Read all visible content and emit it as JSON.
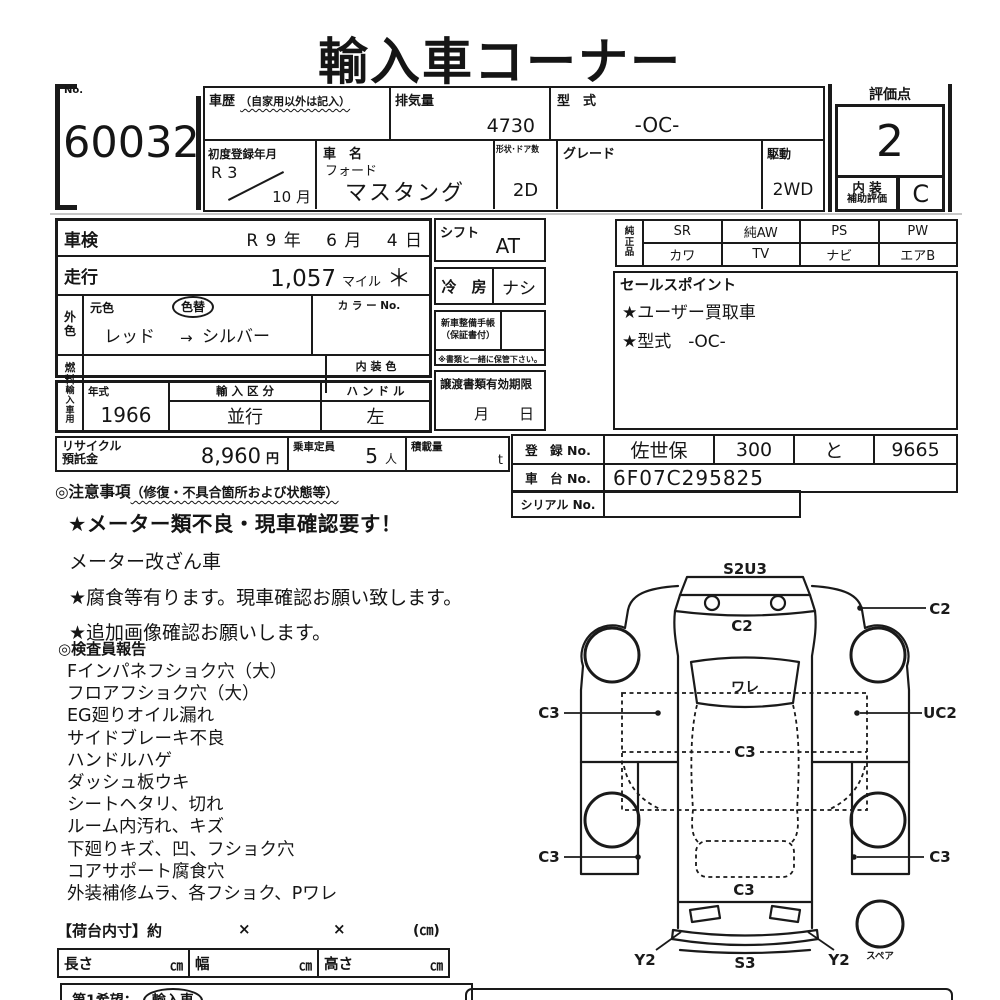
{
  "title": "輸入車コーナー",
  "lot": {
    "no_label": "No.",
    "number": "60032"
  },
  "header": {
    "history_label": "車歴",
    "history_note": "（自家用以外は記入）",
    "displacement_label": "排気量",
    "displacement": "4730",
    "model_code_label": "型　式",
    "model_code": "-OC-",
    "first_reg_label": "初度登録年月",
    "first_reg_year": "R 3",
    "first_reg_month": "10 月",
    "name_label": "車　名",
    "maker": "フォード",
    "car_name": "マスタング",
    "doors_label": "形状･ドア数",
    "doors": "2D",
    "grade_label": "グレード",
    "grade": "",
    "drive_label": "駆動",
    "drive": "2WD"
  },
  "rating": {
    "label": "評価点",
    "score": "2",
    "interior_label1": "内 装",
    "interior_label2": "補助評価",
    "interior_grade": "C"
  },
  "info": {
    "shaken_label": "車検",
    "shaken_value": "R 9 年　 6 月　 4 日",
    "mileage_label": "走行",
    "mileage": "1,057",
    "mileage_unit": "マイル",
    "mileage_mark": "＊",
    "ext_color_label": "外色",
    "orig_color_label": "元色",
    "color_change_label": "色替",
    "color_value": "レッド",
    "color_arrow": "→",
    "color_value2": "シルバー",
    "color_no_label": "カ ラ ー No.",
    "fuel_label": "燃料",
    "interior_color_label": "内 装 色",
    "import_label": "輸入車用",
    "year_label": "年式",
    "year": "1966",
    "import_class_label": "輸 入 区 分",
    "import_class": "並行",
    "handle_label": "ハ ン ド ル",
    "handle": "左"
  },
  "middle": {
    "shift_label": "シフト",
    "shift": "AT",
    "ac_label": "冷　房",
    "ac": "ナシ",
    "service_book_label1": "新車整備手帳",
    "service_book_label2": "（保証書付）",
    "service_note": "※書類と一緒に保管下さい。",
    "transfer_label": "譲渡書類有効期限",
    "transfer_value": "月　　日"
  },
  "equipment": {
    "label": "純正品",
    "row1": [
      "SR",
      "純AW",
      "PS",
      "PW"
    ],
    "row2": [
      "カワ",
      "TV",
      "ナビ",
      "エアB"
    ]
  },
  "sales": {
    "label": "セールスポイント",
    "items": [
      "★ユーザー買取車",
      "★型式　-OC-"
    ]
  },
  "registration": {
    "reg_label": "登　録 No.",
    "reg_area": "佐世保",
    "reg_class": "300",
    "reg_kana": "と",
    "reg_number": "9665",
    "chassis_label": "車　台 No.",
    "chassis": "6F07C295825",
    "serial_label": "シリアル No."
  },
  "recycle": {
    "label1": "リサイクル",
    "label2": "預託金",
    "amount": "8,960",
    "unit": "円",
    "capacity_label": "乗車定員",
    "capacity": "5",
    "capacity_unit": "人",
    "load_label": "積載量",
    "load_unit": "t"
  },
  "cautions": {
    "heading": "◎注意事項",
    "heading_note": "（修復・不具合箇所および状態等）",
    "alert": "★メーター類不良・現車確認要す！",
    "lines": [
      "メーター改ざん車",
      "★腐食等有ります。現車確認お願い致します。",
      "★追加画像確認お願いします。"
    ]
  },
  "inspector": {
    "heading": "◎検査員報告",
    "items": [
      "Fインパネフショク穴（大）",
      "フロアフショク穴（大）",
      "EG廻りオイル漏れ",
      "サイドブレーキ不良",
      "ハンドルハゲ",
      "ダッシュ板ウキ",
      "シートヘタリ、切れ",
      "ルーム内汚れ、キズ",
      "下廻りキズ、凹、フショク穴",
      "コアサポート腐食穴",
      "外装補修ムラ、各フショク、Pワレ"
    ]
  },
  "cargo": {
    "label": "【荷台内寸】約",
    "x1": "×",
    "x2": "×",
    "unit": "(㎝)",
    "length_label": "長さ",
    "width_label": "幅",
    "height_label": "高さ",
    "cm": "㎝"
  },
  "bottom": {
    "choice_label": "第1希望：",
    "choice_value": "輸入車",
    "right_partial": "◆"
  },
  "diagram": {
    "s2u3": "S2U3",
    "c2_hood": "C2",
    "ware": "ワレ",
    "c2_right": "C2",
    "c3_left_upper": "C3",
    "uc2": "UC2",
    "c3_center": "C3",
    "c3_left_lower": "C3",
    "c3_right_lower": "C3",
    "c3_rear": "C3",
    "y2_left": "Y2",
    "s3": "S3",
    "y2_right": "Y2",
    "spare": "スペア"
  }
}
